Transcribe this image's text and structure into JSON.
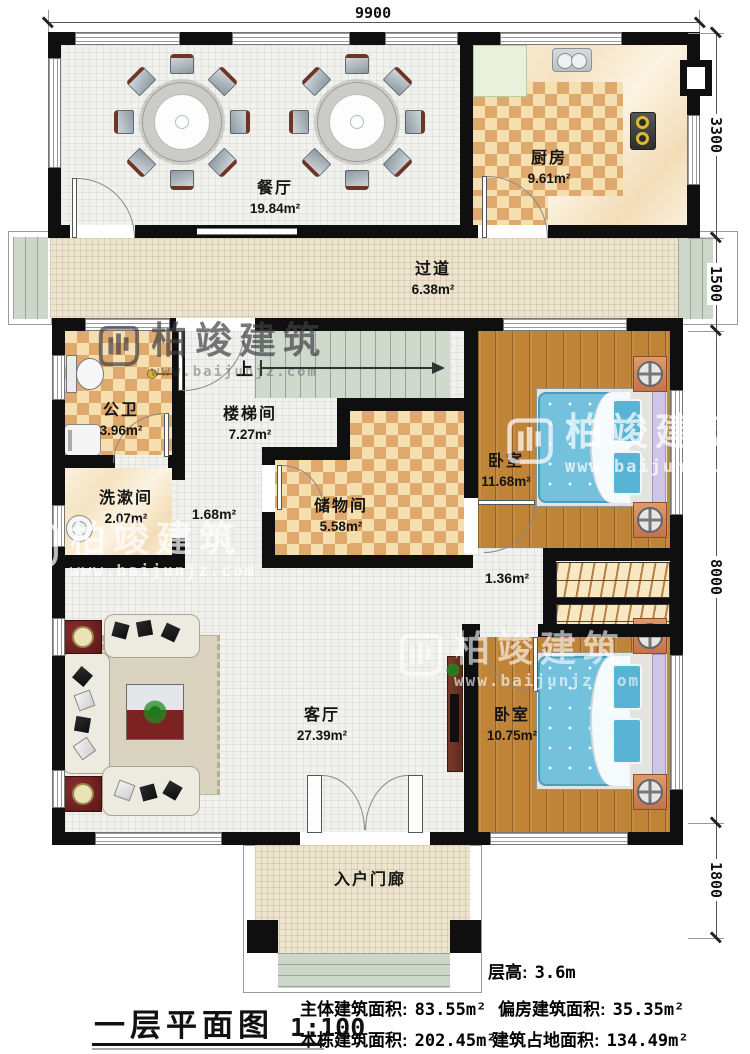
{
  "dimensions": {
    "top": "9900",
    "right": [
      "3300",
      "1500",
      "8000",
      "1800"
    ]
  },
  "rooms": {
    "dining": {
      "name": "餐厅",
      "area": "19.84m²"
    },
    "kitchen": {
      "name": "厨房",
      "area": "9.61m²"
    },
    "corridor": {
      "name": "过道",
      "area": "6.38m²"
    },
    "bathroom": {
      "name": "公卫",
      "area": "3.96m²"
    },
    "stairwell": {
      "name": "楼梯间",
      "area": "7.27m²"
    },
    "washroom": {
      "name": "洗漱间",
      "area": "2.07m²"
    },
    "storage": {
      "name": "储物间",
      "area": "5.58m²"
    },
    "bedroom_top": {
      "name": "卧室",
      "area": "11.68m²"
    },
    "living": {
      "name": "客厅",
      "area": "27.39m²"
    },
    "bedroom_bottom": {
      "name": "卧室",
      "area": "10.75m²"
    },
    "porch": {
      "name": "入户门廊"
    }
  },
  "small_areas": {
    "mid_hall": "1.68m²",
    "bedroom_hall": "1.36m²"
  },
  "stairs": {
    "up": "上"
  },
  "footer": {
    "title": "一层平面图",
    "scale": "1:100",
    "floor_height": {
      "label": "层高:",
      "value": "3.6m"
    },
    "stats": [
      {
        "label": "主体建筑面积:",
        "value": "83.55m²"
      },
      {
        "label": "偏房建筑面积:",
        "value": "35.35m²"
      },
      {
        "label": "本栋建筑面积:",
        "value": "202.45m²"
      },
      {
        "label": "建筑占地面积:",
        "value": "134.49m²"
      }
    ]
  },
  "watermark": {
    "brand": "柏竣建筑",
    "url": "www.baijunjz.com"
  }
}
